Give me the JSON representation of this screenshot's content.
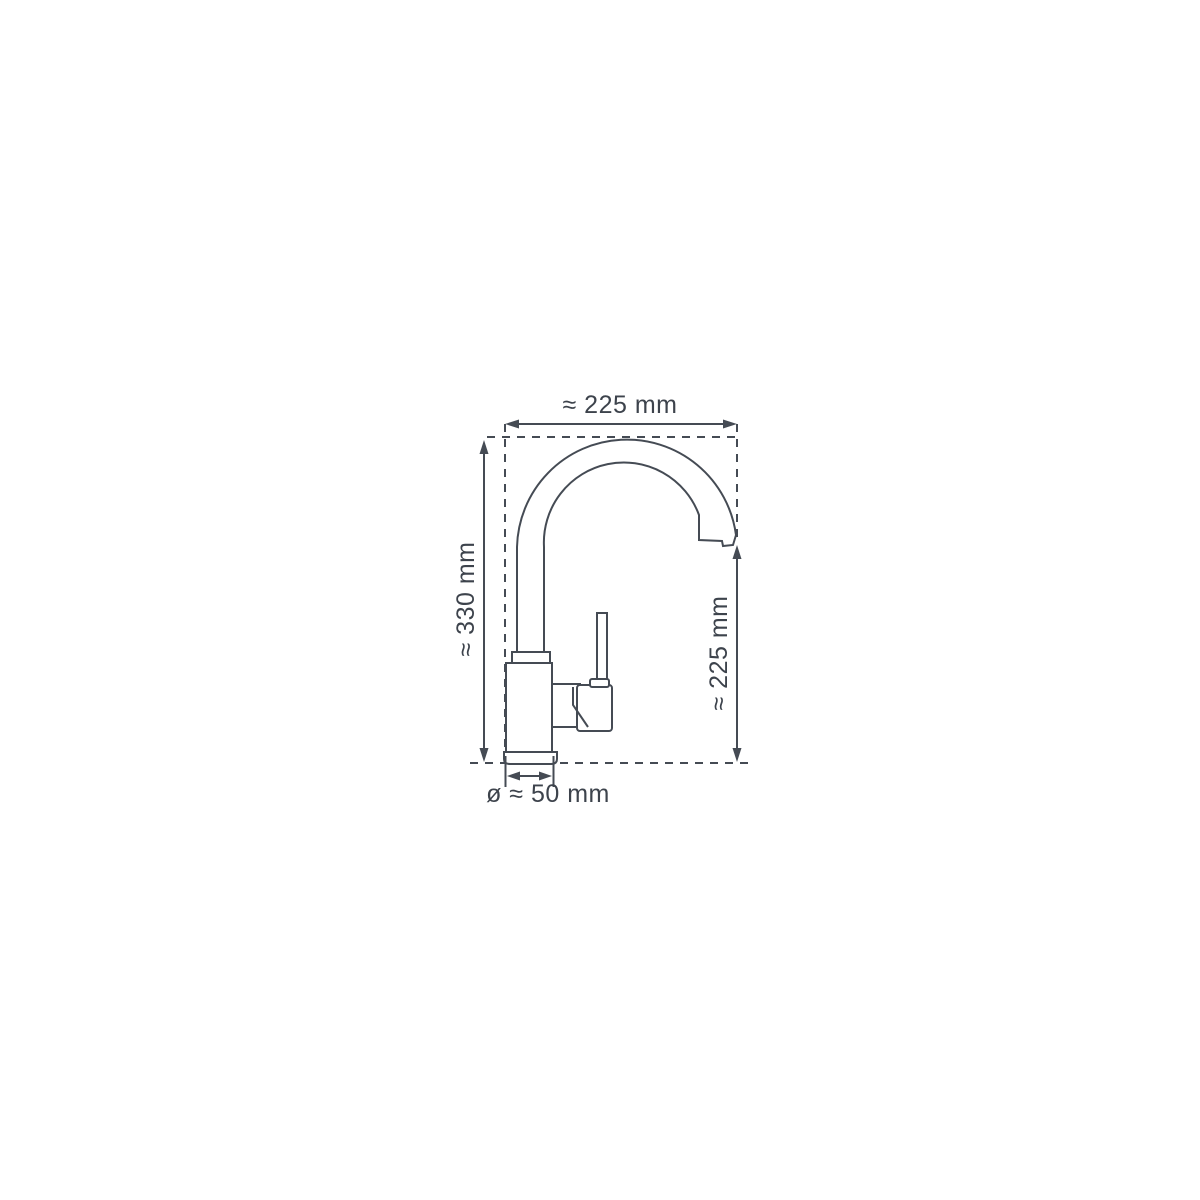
{
  "diagram": {
    "subject": "kitchen-faucet-side-view-dimension-drawing",
    "labels": {
      "top_width": "≈ 225 mm",
      "left_height": "≈ 330 mm",
      "right_height": "≈ 225 mm",
      "base_diameter": "ø ≈ 50 mm"
    },
    "values_mm": {
      "top_width": 225,
      "left_height": 330,
      "right_height": 225,
      "base_diameter": 50
    },
    "colors": {
      "line": "#454b54",
      "text": "#3d434c",
      "background": "#ffffff"
    }
  }
}
